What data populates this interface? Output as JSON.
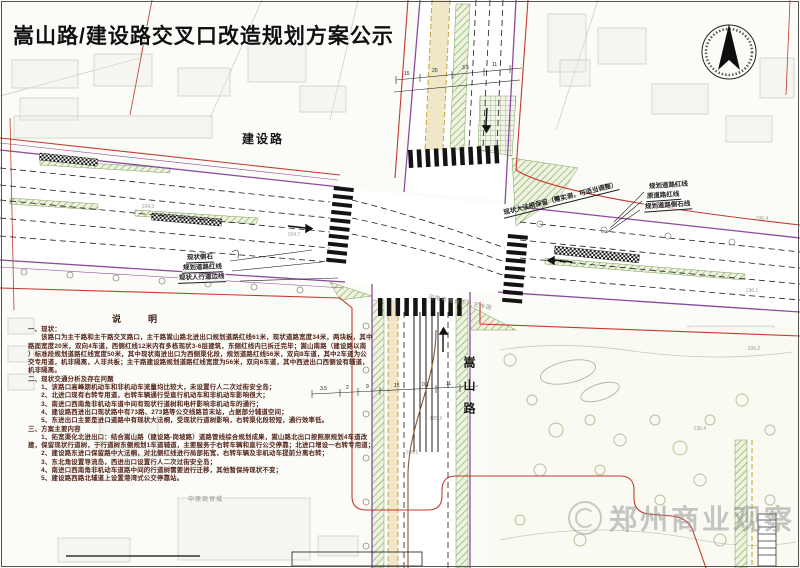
{
  "title": "嵩山路/建设路交叉口改造规划方案公示",
  "roads": {
    "east_west": "建设路",
    "north_south": "嵩山路"
  },
  "callouts": {
    "left": [
      "现状侧石",
      "规划道路红线",
      "现状人行道边线"
    ],
    "right": [
      "规划道路红线",
      "原道路红线",
      "规划道路侧石线"
    ],
    "tree_note": "现状大法桐保留（需实测，可适当调整）"
  },
  "background_labels": {
    "market": "中原商贸城",
    "tv": "河南电视台少儿艺术团"
  },
  "notes": {
    "heading": "说　明",
    "lines": [
      "一、现状：",
      "　　该路口为主干路和主干路交叉路口，主干路嵩山路北进出口规划道路红线61米，现状道路宽度34米，两块板，其中",
      "路面宽度20米，双向4车道，西侧红线12米内有多栋现状3-6层建筑，东侧红线内已拆迁完毕；嵩山南路（建设路以南",
      "）标准段规划道路红线宽度50米，其中现状南进出口为西侧渠化段，规划道路红线56米，双向8车道，其中2车道为公",
      "交专用道，机非隔离，人非共板；主干路建设路规划道路红线宽度为56米，双向6车道，其中西进出口西侧设有辅道，",
      "机非隔离。",
      "二、现状交通分析及存在问题",
      "　　1、该路口高峰期机动车和非机动车流量均比较大，未设置行人二次过街安全岛；",
      "　　2、北进口现有右转专用道，右转车辆通行受直行机动车和非机动车影响很大；",
      "　　3、南进口西南角非机动车道中间有现状行道树和电杆影响非机动车的通行；",
      "　　4、建设路西进出口现状路中有73路、273路等公交线路首末站，占据部分辅道空间；",
      "　　5、东进出口主要是进口道路中有现状大法桐，受现状行道树影响，右转渠化段较短，通行效率低。",
      "三、方案主要内容",
      "　　1、拓宽渠化北进出口：结合嵩山路（建设路-岗坡路）道路管线综合规划成果，嵩山路北出口按照原规划4车道改",
      "建，保留现状行道树，于行道树东侧规划1车道辅道，主要服务于右转车辆和直行公交停靠；北进口增设一右转专用道；",
      "　　2、建设路东进口保留路中大法桐，对北侧红线进行局部拓宽，右转车辆及非机动车提前分离右转；",
      "　　3、东北角设置导流岛，西进出口设置行人二次过街安全岛；",
      "　　4、南进口西南角非机动车道路中间的行道树需要进行迁移，其他暂保持现状不变；",
      "　　5、建设路西路北辅道上设置港湾式公交停靠站。"
    ]
  },
  "dimensions": {
    "north": [
      "15",
      "20",
      "3.5",
      "11"
    ],
    "south": [
      "3.5",
      "2",
      "9",
      "15",
      "0.1",
      "11"
    ]
  },
  "spot_elevations": [
    "·104.3",
    "·104.7",
    "·105.1",
    "·105.3",
    "·106.4",
    "·136.1",
    "·136.4",
    "·106.2"
  ],
  "watermark": {
    "text": "郑州商业观察"
  },
  "compass": {
    "name": "north-arrow"
  },
  "colors": {
    "red_line": "#c23b2e",
    "purple_line": "#8b4a9e",
    "green_hatch": "#79a156",
    "yellow_band": "#f0e6c8",
    "notes_text": "#53241a"
  }
}
